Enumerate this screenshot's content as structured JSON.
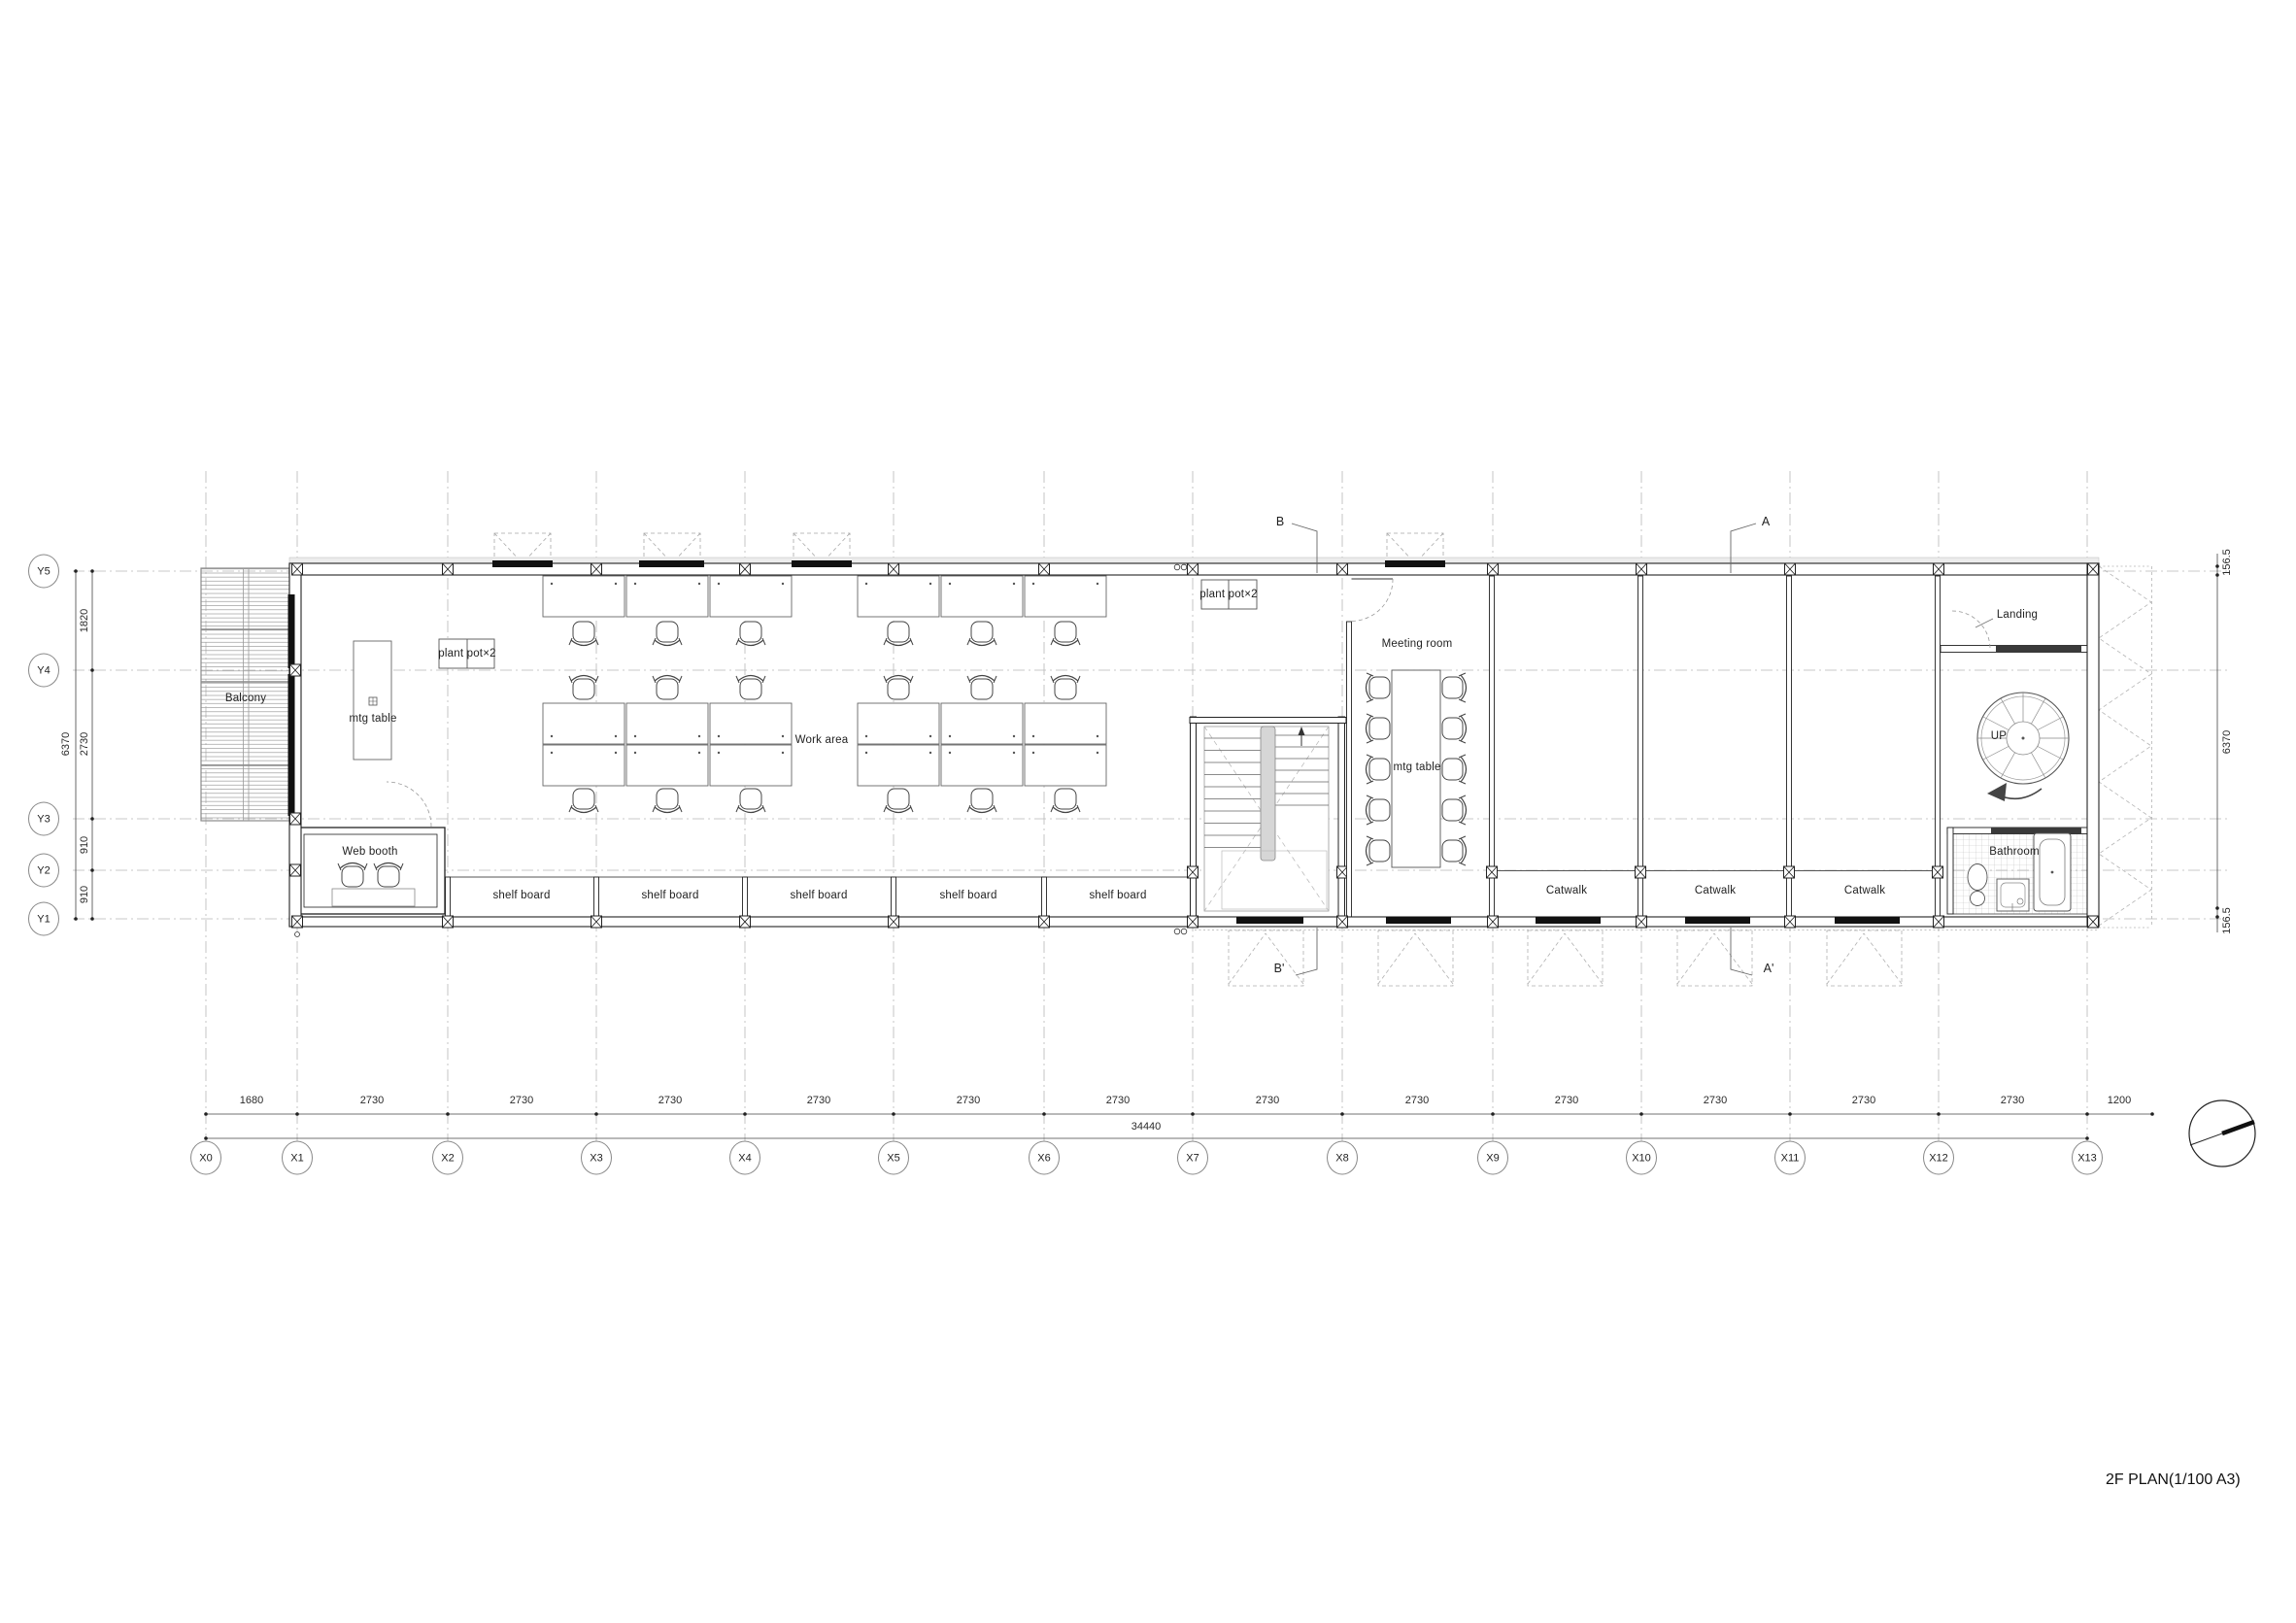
{
  "title": "2F PLAN(1/100 A3)",
  "grid": {
    "x_labels": [
      "X0",
      "X1",
      "X2",
      "X3",
      "X4",
      "X5",
      "X6",
      "X7",
      "X8",
      "X9",
      "X10",
      "X11",
      "X12",
      "X13"
    ],
    "y_labels": [
      "Y5",
      "Y4",
      "Y3",
      "Y2",
      "Y1"
    ]
  },
  "dimensions": {
    "bottom_segments": [
      "1680",
      "2730",
      "2730",
      "2730",
      "2730",
      "2730",
      "2730",
      "2730",
      "2730",
      "2730",
      "2730",
      "2730",
      "2730",
      "1200"
    ],
    "bottom_total": "34440",
    "left_segments": [
      "1820",
      "2730",
      "910",
      "910"
    ],
    "left_total": "6370",
    "right_segments": [
      "156.5",
      "6370",
      "156.5"
    ]
  },
  "rooms": {
    "balcony": "Balcony",
    "web_booth": "Web booth",
    "work_area": "Work area",
    "meeting_room": "Meeting room",
    "landing": "Landing",
    "bathroom": "Bathroom",
    "catwalks": [
      "Catwalk",
      "Catwalk",
      "Catwalk"
    ]
  },
  "labels": {
    "mtg_table_left": "mtg table",
    "mtg_table_meeting": "mtg table",
    "plant_pot_1": "plant pot×2",
    "plant_pot_2": "plant pot×2",
    "shelf_boards": [
      "shelf board",
      "shelf board",
      "shelf board",
      "shelf board",
      "shelf board"
    ],
    "up": "UP"
  },
  "sections": {
    "b": "B",
    "a": "A",
    "b_prime": "B'",
    "a_prime": "A'"
  },
  "colors": {
    "line": "#222222",
    "grid": "#b8b8b8",
    "stair_fill": "#d6d6d6",
    "paper": "#ffffff"
  }
}
